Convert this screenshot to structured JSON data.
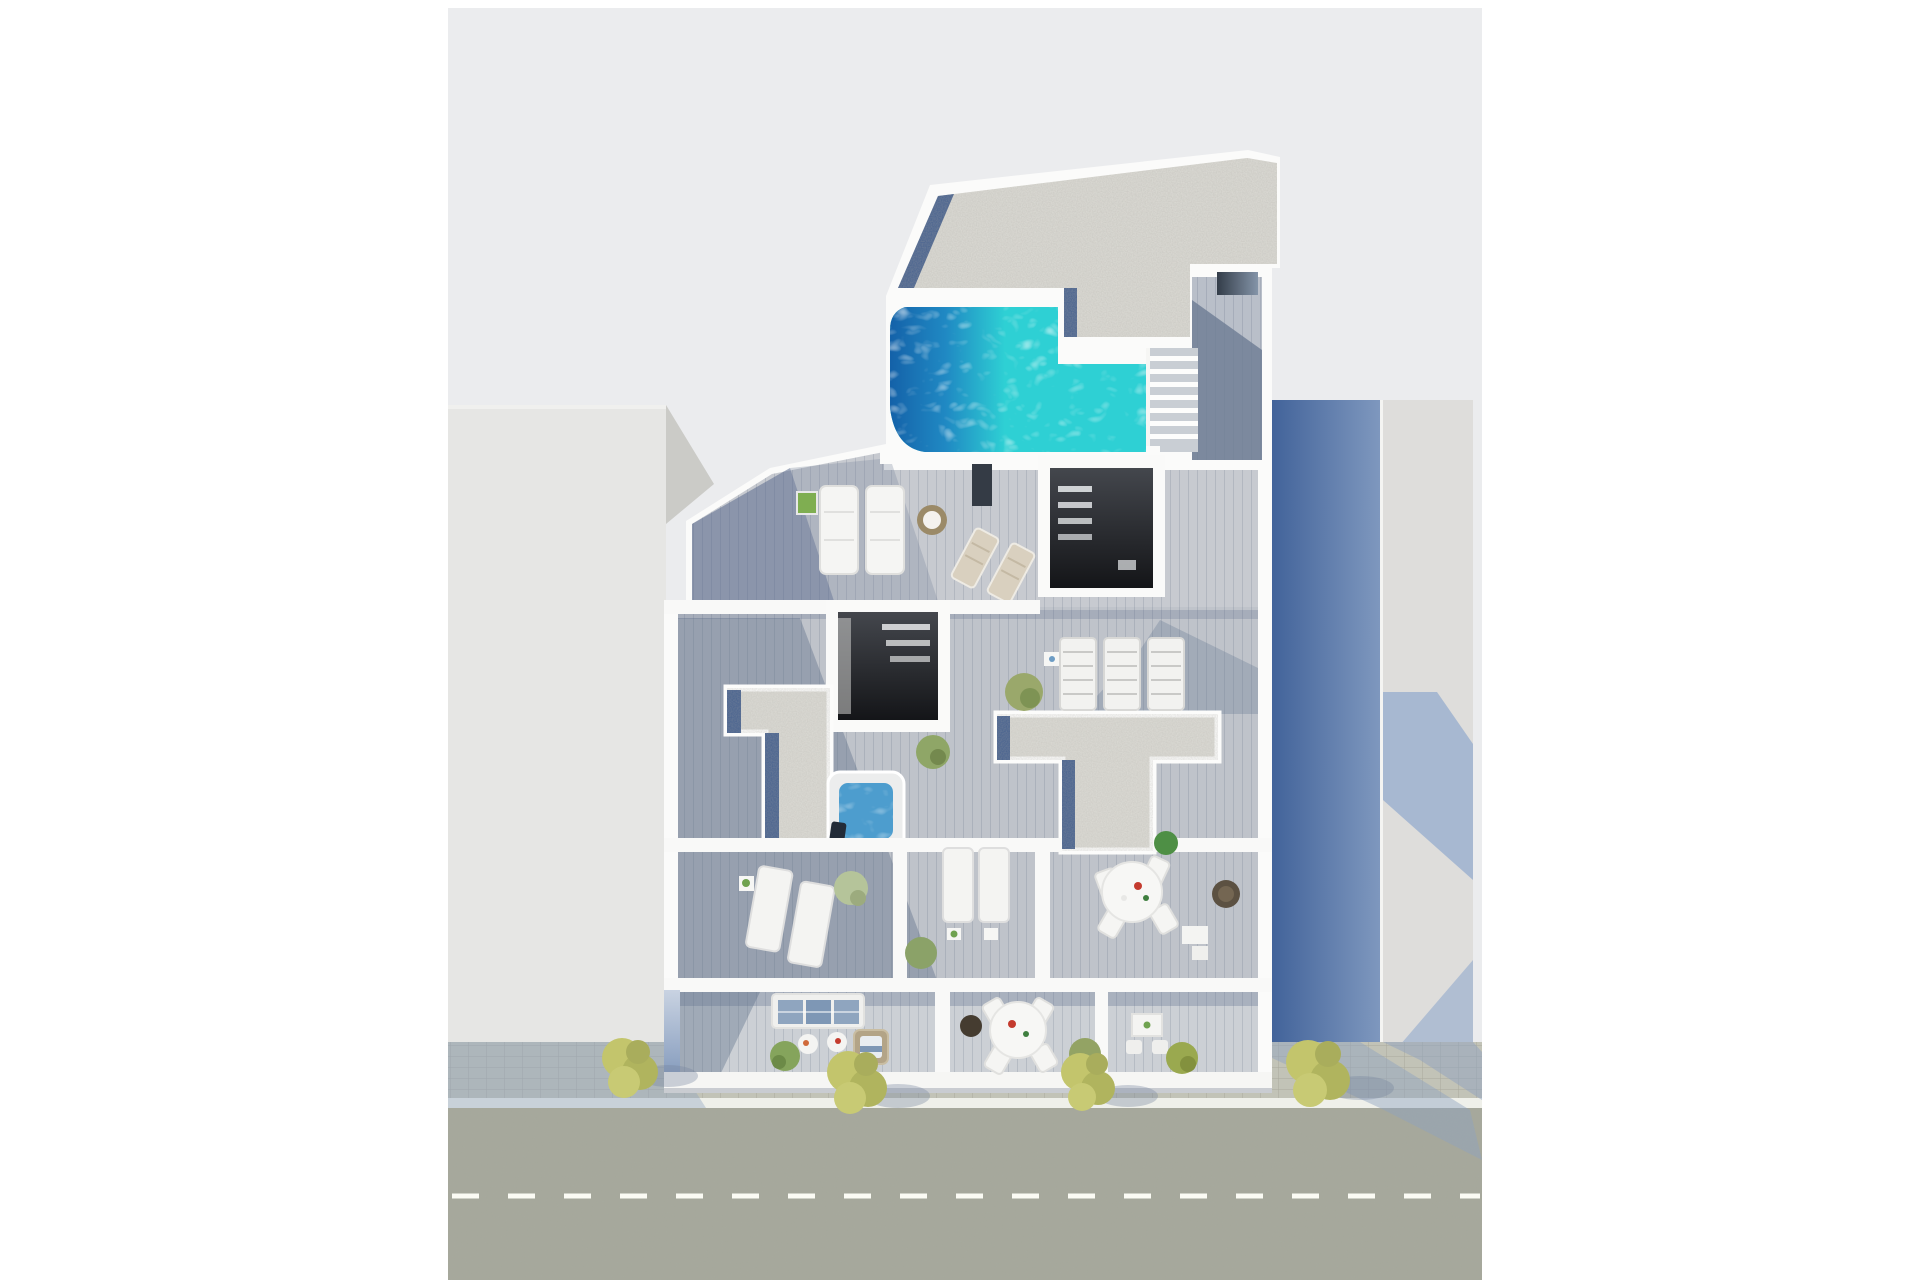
{
  "scene": {
    "type": "architectural 3D render",
    "view": "top-down aerial view",
    "subject": "Top-down 3D rendering of a residential building rooftop and terraces with swimming pool, jacuzzi, sun loungers, dining terraces, balconies and a street with trees below",
    "palette": {
      "page_background": "#ffffff",
      "ground_backdrop": "#ebecee",
      "building_white": "#fbfbfa",
      "deck_wood_light": "#c6c9ce",
      "deck_wood_shadow": "#76849d",
      "gravel_roof": "#dddcd6",
      "skylight_glass_strip": "#46618f",
      "pool_water": "#2ed0d4",
      "pool_shadow": "#1a63a8",
      "jacuzzi_water": "#4d9dce",
      "neighbor_left_building": "#e6e6e4",
      "neighbor_right_face": "#dedddb",
      "neighbor_right_shadow_wall": "#5b7aa8",
      "road": "#a5a89b",
      "sidewalk": "#c2c3b7",
      "road_marking": "#fbfbf4",
      "tree_foliage": "#b9bd68",
      "cast_shadow": "#9db1cf"
    },
    "rooftop": {
      "pool": {
        "shape": "L-shaped",
        "water_color": "#2ed0d4",
        "shaded_side": "left"
      },
      "gravel_roof_sections": 3,
      "skylight_openings": 2,
      "staircase_steps": 7,
      "jacuzzi_count": 1
    },
    "furniture": {
      "upper_terrace": [
        "2 white padded sun loungers",
        "green potted plant",
        "round wicker chair",
        "2 beige folding deck chairs",
        "dark outdoor shower panel"
      ],
      "middle_floor": [
        "jacuzzi hot tub with towel",
        "3 white slatted day beds",
        "potted tree",
        "2 white sun loungers in left room",
        "2 white sun loungers in middle room",
        "round dining table with 4 white chairs",
        "round dark wicker chair",
        "small white desk with chair",
        "green shrubs"
      ],
      "balconies": [
        "white sofa with blue cushions",
        "2 small white coffee tables with fruit trays",
        "wicker day bed with cushion",
        "round white dining table with 4 chairs",
        "dark wicker pouf",
        "small white bistro table with 2 chairs",
        "green shrubs"
      ]
    },
    "street": {
      "tree_count": 4,
      "road_marking": "dashed white center line",
      "sidewalk": "paved with concrete slabs"
    }
  }
}
